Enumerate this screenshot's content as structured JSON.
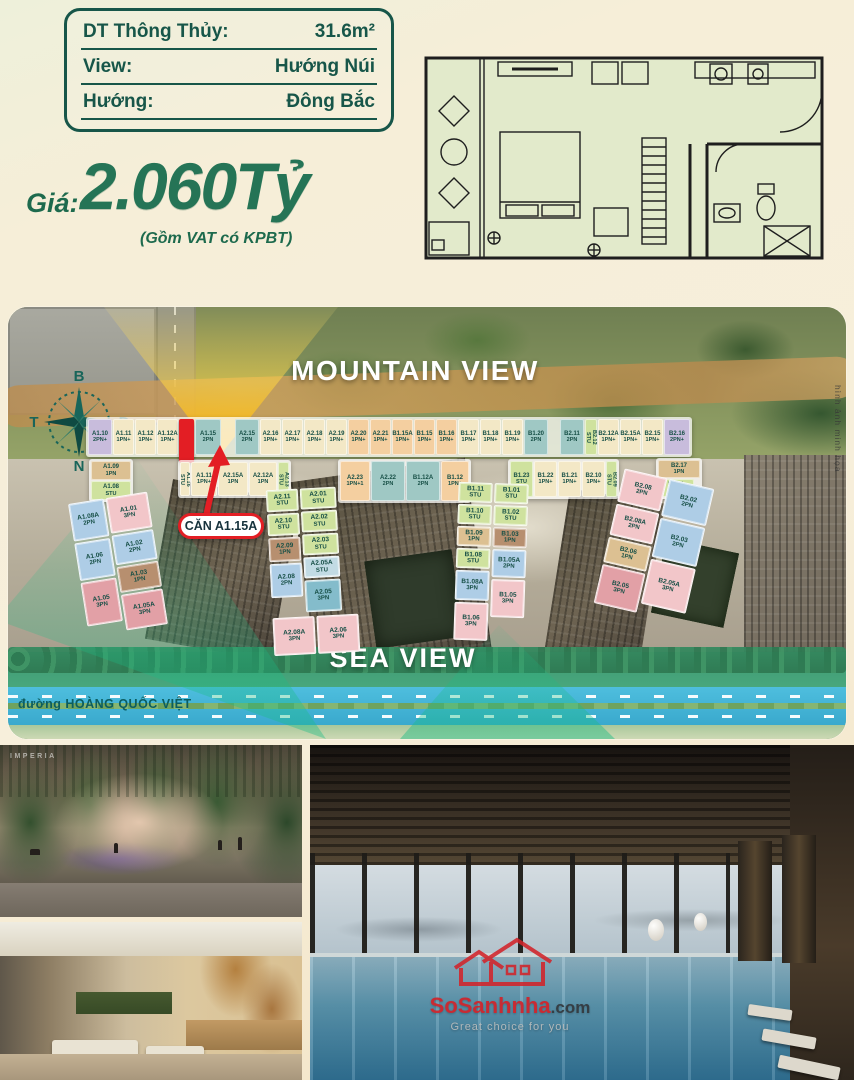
{
  "spec_box": {
    "rows": [
      {
        "label": "DT Thông Thủy:",
        "value": "31.6m²"
      },
      {
        "label": "View:",
        "value": "Hướng Núi"
      },
      {
        "label": "Hướng:",
        "value": "Đông Bắc"
      }
    ]
  },
  "price": {
    "label": "Giá:",
    "amount": "2.060Tỷ",
    "note": "(Gồm VAT có KPBT)"
  },
  "site_plan": {
    "mountain_view": "MOUNTAIN VIEW",
    "sea_view": "SEA VIEW",
    "road_label": "đường HOÀNG QUỐC VIỆT",
    "callout_label": "CĂN A1.15A",
    "photo_note": "hình ảnh minh họa",
    "compass": {
      "north": "B",
      "east": "Đ",
      "west": "T",
      "south": "N"
    },
    "legend_colors": {
      "lav": "#c8bcdc",
      "cream": "#f3e8c6",
      "orange": "#f4cfa0",
      "teal": "#9fc8c4",
      "green": "#cfe29e",
      "blue": "#aecde6",
      "pink": "#f2c6c9",
      "dpink": "#e2a0a6",
      "tan": "#dcc092",
      "brown": "#b78f6f",
      "red": "#e31e24",
      "bluegrey": "#c2dbe4",
      "tealblue": "#84bccb"
    },
    "cells": {
      "row1": [
        {
          "id": "A1.10",
          "t": "2PN+",
          "c": "lav",
          "w": 24
        },
        {
          "id": "A1.11",
          "t": "1PN+",
          "c": "cream"
        },
        {
          "id": "A1.12",
          "t": "1PN+",
          "c": "cream"
        },
        {
          "id": "A1.12A",
          "t": "1PN+",
          "c": "cream"
        },
        {
          "id": "",
          "t": "",
          "c": "red",
          "red": true,
          "w": 15
        },
        {
          "id": "A1.15",
          "t": "2PN",
          "c": "teal",
          "w": 26
        },
        {
          "sp": true,
          "w": 12
        },
        {
          "id": "A2.15",
          "t": "2PN",
          "c": "teal",
          "w": 24
        },
        {
          "id": "A2.16",
          "t": "1PN+",
          "c": "cream"
        },
        {
          "id": "A2.17",
          "t": "1PN+",
          "c": "cream"
        },
        {
          "id": "A2.18",
          "t": "1PN+",
          "c": "cream"
        },
        {
          "id": "A2.19",
          "t": "1PN+",
          "c": "cream"
        },
        {
          "id": "A2.20",
          "t": "1PN+",
          "c": "orange"
        },
        {
          "id": "A2.21",
          "t": "1PN+",
          "c": "orange"
        },
        {
          "id": "B1.15A",
          "t": "1PN+",
          "c": "orange"
        },
        {
          "id": "B1.15",
          "t": "1PN+",
          "c": "orange"
        },
        {
          "id": "B1.16",
          "t": "1PN+",
          "c": "orange"
        },
        {
          "id": "B1.17",
          "t": "1PN+",
          "c": "cream"
        },
        {
          "id": "B1.18",
          "t": "1PN+",
          "c": "cream"
        },
        {
          "id": "B1.19",
          "t": "1PN+",
          "c": "cream"
        },
        {
          "id": "B1.20",
          "t": "2PN",
          "c": "teal",
          "w": 24
        },
        {
          "sp": true,
          "w": 10
        },
        {
          "id": "B2.11",
          "t": "2PN",
          "c": "teal",
          "w": 24
        },
        {
          "id": "B2.12",
          "t": "STU",
          "c": "green",
          "v": true,
          "w": 12
        },
        {
          "id": "B2.12A",
          "t": "1PN+",
          "c": "cream"
        },
        {
          "id": "B2.15A",
          "t": "1PN+",
          "c": "cream"
        },
        {
          "id": "B2.15",
          "t": "1PN+",
          "c": "cream"
        },
        {
          "id": "B2.16",
          "t": "2PN+",
          "c": "lav",
          "w": 26
        }
      ],
      "row2a": [
        {
          "id": "A1.09",
          "t": "1PN",
          "c": "tan"
        },
        {
          "id": "A1.08",
          "t": "STU",
          "c": "green"
        }
      ],
      "row2b": [
        {
          "id": "A1.16",
          "t": "STU",
          "c": "cream",
          "v": true,
          "w": 10
        },
        {
          "id": "A1.11",
          "t": "1PN+",
          "c": "cream",
          "w": 26
        },
        {
          "id": "A2.15A",
          "t": "1PN",
          "c": "cream",
          "w": 30
        },
        {
          "id": "A2.12A",
          "t": "1PN",
          "c": "cream",
          "w": 28
        },
        {
          "id": "A2.13",
          "t": "STU",
          "c": "green",
          "v": true,
          "w": 11
        }
      ],
      "row2c": [
        {
          "id": "A2.23",
          "t": "1PN+1",
          "c": "orange",
          "w": 30
        },
        {
          "id": "A2.22",
          "t": "2PN",
          "c": "teal",
          "w": 34
        },
        {
          "id": "B1.12A",
          "t": "2PN",
          "c": "teal",
          "w": 34
        },
        {
          "id": "B1.12",
          "t": "1PN+",
          "c": "orange",
          "w": 28
        }
      ],
      "row2d": [
        {
          "id": "B1.23",
          "t": "STU",
          "c": "green"
        },
        {
          "id": "B1.22",
          "t": "1PN+",
          "c": "cream"
        },
        {
          "id": "B1.21",
          "t": "1PN+",
          "c": "cream"
        },
        {
          "id": "B2.10",
          "t": "1PN+",
          "c": "cream"
        },
        {
          "id": "B2.09",
          "t": "STU",
          "c": "green",
          "v": true,
          "w": 11
        }
      ],
      "row2e": [
        {
          "id": "B2.17",
          "t": "1PN",
          "c": "tan"
        },
        {
          "id": "B2.01",
          "t": "STU",
          "c": "green",
          "w": 36
        }
      ],
      "blockA1_outer": [
        {
          "id": "A1.08A",
          "t": "2PN",
          "c": "blue",
          "h": 38
        },
        {
          "id": "A1.06",
          "t": "2PN",
          "c": "blue",
          "h": 38
        },
        {
          "id": "A1.05",
          "t": "3PN",
          "c": "dpink",
          "h": 44
        }
      ],
      "blockA1_inner": [
        {
          "id": "A1.01",
          "t": "3PN",
          "c": "pink",
          "h": 36,
          "w": 42
        },
        {
          "id": "A1.02",
          "t": "2PN",
          "c": "blue",
          "h": 30,
          "w": 42
        },
        {
          "id": "A1.03",
          "t": "1PN",
          "c": "brown",
          "h": 26,
          "w": 42
        },
        {
          "id": "A1.05A",
          "t": "3PN",
          "c": "dpink",
          "h": 36,
          "w": 42
        }
      ],
      "blockA2_outer": [
        {
          "id": "A2.11",
          "t": "STU",
          "c": "green",
          "h": 22,
          "w": 32
        },
        {
          "id": "A2.10",
          "t": "STU",
          "c": "green",
          "h": 22,
          "w": 32
        },
        {
          "id": "A2.09",
          "t": "1PN",
          "c": "brown",
          "h": 24,
          "w": 32
        },
        {
          "id": "A2.08",
          "t": "2PN",
          "c": "blue",
          "h": 34,
          "w": 32
        }
      ],
      "blockA2_inner": [
        {
          "id": "A2.01",
          "t": "STU",
          "c": "green",
          "h": 21
        },
        {
          "id": "A2.02",
          "t": "STU",
          "c": "green",
          "h": 21
        },
        {
          "id": "A2.03",
          "t": "STU",
          "c": "green",
          "h": 21
        },
        {
          "id": "A2.05A",
          "t": "STU",
          "c": "bluegrey",
          "h": 21
        },
        {
          "id": "A2.05",
          "t": "3PN",
          "c": "tealblue",
          "h": 32
        }
      ],
      "blockA2_bottom": [
        {
          "id": "A2.08A",
          "t": "3PN",
          "c": "pink",
          "h": 38,
          "w": 42
        },
        {
          "id": "A2.06",
          "t": "3PN",
          "c": "pink",
          "h": 38,
          "w": 42
        }
      ],
      "blockB1_outer": [
        {
          "id": "B1.11",
          "t": "STU",
          "c": "green",
          "h": 20,
          "w": 34
        },
        {
          "id": "B1.10",
          "t": "STU",
          "c": "green",
          "h": 20,
          "w": 34
        },
        {
          "id": "B1.09",
          "t": "1PN",
          "c": "tan",
          "h": 20,
          "w": 34
        },
        {
          "id": "B1.08",
          "t": "STU",
          "c": "green",
          "h": 20,
          "w": 34
        },
        {
          "id": "B1.08A",
          "t": "3PN",
          "c": "blue",
          "h": 30,
          "w": 34
        },
        {
          "id": "B1.06",
          "t": "3PN",
          "c": "pink",
          "h": 38,
          "w": 34
        }
      ],
      "blockB1_inner": [
        {
          "id": "B1.01",
          "t": "STU",
          "c": "green",
          "h": 20,
          "w": 34
        },
        {
          "id": "B1.02",
          "t": "STU",
          "c": "green",
          "h": 20,
          "w": 34
        },
        {
          "id": "B1.03",
          "t": "1PN",
          "c": "brown",
          "h": 20,
          "w": 34
        },
        {
          "id": "B1.05A",
          "t": "2PN",
          "c": "blue",
          "h": 28,
          "w": 34
        },
        {
          "id": "B1.05",
          "t": "3PN",
          "c": "pink",
          "h": 38,
          "w": 34
        }
      ],
      "blockB2_left": [
        {
          "id": "B2.08",
          "t": "2PN",
          "c": "pink",
          "h": 34,
          "w": 44
        },
        {
          "id": "B2.08A",
          "t": "2PN",
          "c": "pink",
          "h": 32,
          "w": 44
        },
        {
          "id": "B2.06",
          "t": "1PN",
          "c": "tan",
          "h": 26,
          "w": 44
        },
        {
          "id": "B2.05",
          "t": "3PN",
          "c": "dpink",
          "h": 40,
          "w": 44
        }
      ],
      "blockB2_right": [
        {
          "id": "B2.02",
          "t": "2PN",
          "c": "blue",
          "h": 38,
          "w": 46
        },
        {
          "id": "B2.03",
          "t": "2PN",
          "c": "blue",
          "h": 40,
          "w": 46
        },
        {
          "id": "B2.05A",
          "t": "3PN",
          "c": "pink",
          "h": 46,
          "w": 46
        }
      ]
    }
  },
  "photos": {
    "brand_logo": "IMPERIA"
  },
  "watermark": {
    "site": "SoSanhnha",
    "suffix": ".com",
    "tagline": "Great choice for you"
  }
}
